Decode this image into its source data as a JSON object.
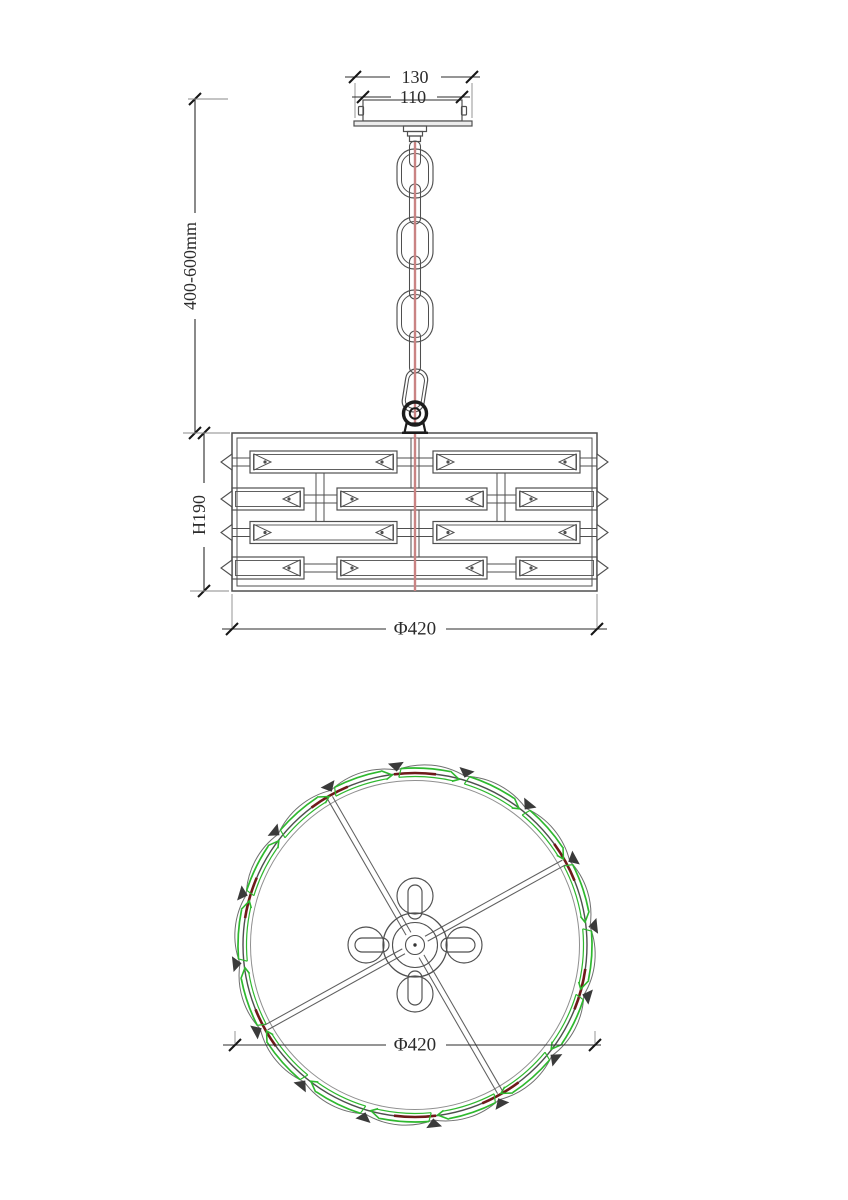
{
  "drawing": {
    "dimensions": {
      "canopy_width": "130",
      "canopy_body_width": "110",
      "suspension_length": "400-600mm",
      "shade_height": "H190",
      "shade_diameter_side": "Φ420",
      "shade_diameter_plan": "Φ420"
    },
    "colors": {
      "line": "#4f4f4f",
      "dim_line": "#2b2b2b",
      "text": "#2b2b2b",
      "accent_green": "#2eb82e",
      "accent_maroon": "#6e1a1a",
      "cord_red": "#c98383",
      "background": "#ffffff"
    }
  }
}
